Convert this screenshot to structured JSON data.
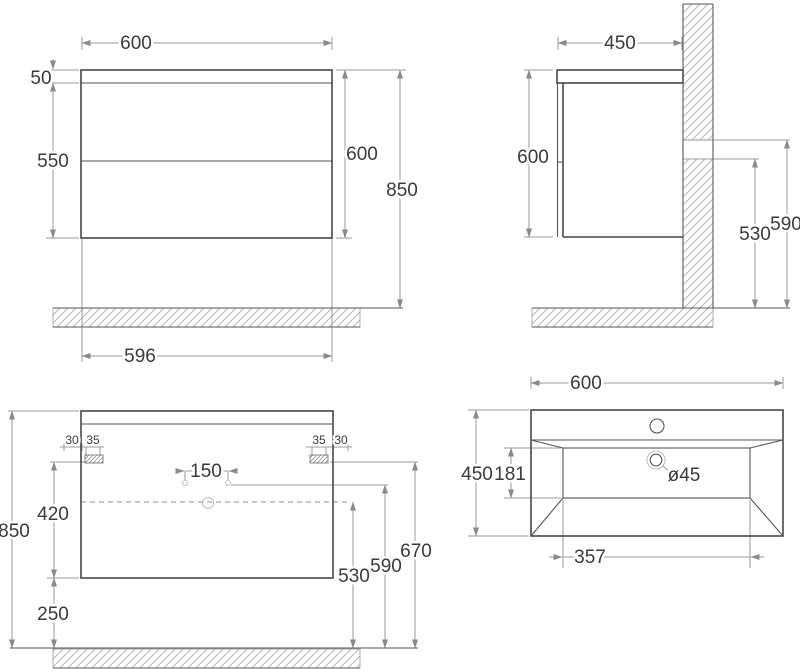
{
  "views": {
    "front": {
      "width": "600",
      "top_thickness": "50",
      "body_height": "550",
      "cabinet_height": "600",
      "mount_height": "850",
      "base_width": "596"
    },
    "side": {
      "depth": "450",
      "height": "600",
      "rail_low": "530",
      "rail_high": "590"
    },
    "back": {
      "edge_left": "30",
      "bracket_left": "35",
      "bracket_right": "35",
      "edge_right": "30",
      "holes_span": "150",
      "hang_height": "420",
      "total_height": "850",
      "floor_clearance": "250",
      "waste_height": "530",
      "holes_height": "590",
      "bracket_height": "670"
    },
    "basin": {
      "width": "600",
      "depth": "450",
      "bowl_depth": "181",
      "drain_diameter": "ø45",
      "bowl_width": "357"
    }
  }
}
